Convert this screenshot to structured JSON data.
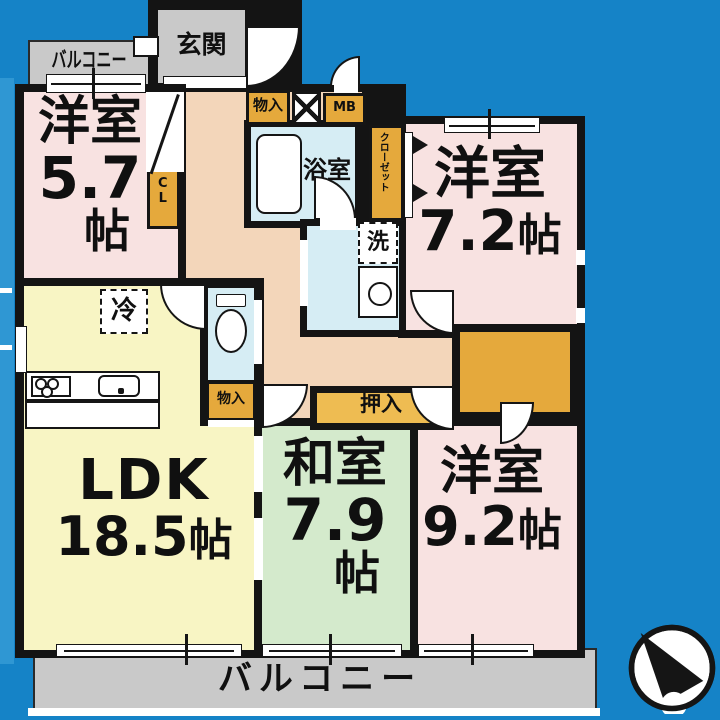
{
  "colors": {
    "background": "#1583c7",
    "left_strip": "#2f97d3",
    "wall": "#141414",
    "room_pink": "#f8e2e1",
    "room_yellow": "#f8f5c4",
    "room_green": "#d4eacc",
    "wet_blue": "#d6edf4",
    "corridor": "#f3d6ba",
    "balcony_gray": "#c9c9c9",
    "storage_orange": "#e5a93c",
    "oshiire_orange": "#eebc52"
  },
  "labels": {
    "balcony_top": "バルコニー",
    "balcony_bottom": "バルコニー",
    "entrance": "玄関",
    "storage_top": "物入",
    "meter_box": "MB",
    "bath": "浴室",
    "closet_vertical": "クローゼット",
    "closet_cl": "CL",
    "laundry": "洗",
    "fridge": "冷",
    "storage_mid": "物入",
    "oshiire": "押入"
  },
  "rooms": {
    "western1": {
      "name": "洋室",
      "size": "5.7",
      "unit": "帖"
    },
    "western2": {
      "name": "洋室",
      "size": "7.2",
      "unit": "帖"
    },
    "ldk": {
      "name": "LDK",
      "size": "18.5",
      "unit": "帖"
    },
    "washitsu": {
      "name": "和室",
      "size": "7.9",
      "unit": "帖"
    },
    "western3": {
      "name": "洋室",
      "size": "9.2",
      "unit": "帖"
    }
  }
}
